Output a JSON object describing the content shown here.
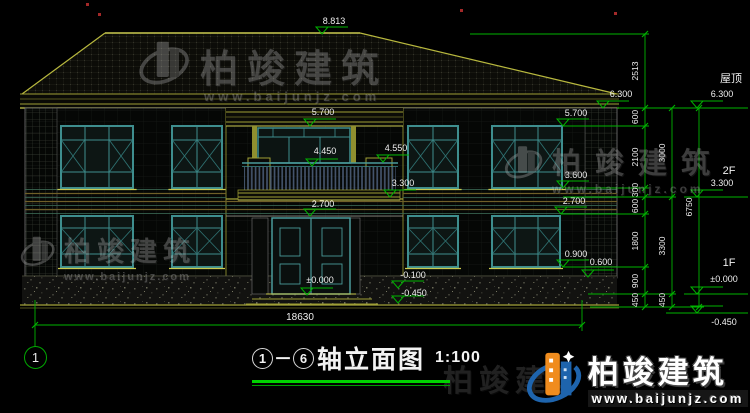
{
  "title_block": {
    "axis_start": "1",
    "separator": "－",
    "axis_end": "6",
    "name": "轴立面图",
    "scale": "1:100"
  },
  "axis_bubble": "1",
  "brand": {
    "name": "柏竣建筑",
    "url": "www.baijunjz.com"
  },
  "colors": {
    "dim_green": "#00b400",
    "text_white": "#f0f0f0",
    "roof_yellow": "#caca50",
    "olive": "#8f8f2f",
    "window_teal": "#3e8e8e",
    "logo_blue": "#1e64ad",
    "logo_orange": "#f08c1e",
    "red_mark": "#c03030"
  },
  "annotations": {
    "level_markers": [
      {
        "label": "8.813",
        "x": 322,
        "y": 34,
        "lx": 334,
        "ly": 24
      },
      {
        "label": "6.300",
        "x": 603,
        "y": 108,
        "lx": 621,
        "ly": 97
      },
      {
        "label": "5.700",
        "x": 310,
        "y": 126,
        "lx": 323,
        "ly": 115
      },
      {
        "label": "5.700",
        "x": 563,
        "y": 126,
        "lx": 576,
        "ly": 116
      },
      {
        "label": "4.450",
        "x": 312,
        "y": 166,
        "lx": 325,
        "ly": 154
      },
      {
        "label": "4.550",
        "x": 383,
        "y": 162,
        "lx": 396,
        "ly": 151
      },
      {
        "label": "3.300",
        "x": 390,
        "y": 197,
        "lx": 403,
        "ly": 186
      },
      {
        "label": "2.700",
        "x": 310,
        "y": 216,
        "lx": 323,
        "ly": 207
      },
      {
        "label": "3.600",
        "x": 563,
        "y": 188,
        "lx": 576,
        "ly": 178
      },
      {
        "label": "2.700",
        "x": 561,
        "y": 214,
        "lx": 574,
        "ly": 204
      },
      {
        "label": "0.900",
        "x": 563,
        "y": 267,
        "lx": 576,
        "ly": 257
      },
      {
        "label": "0.600",
        "x": 588,
        "y": 277,
        "lx": 601,
        "ly": 265
      },
      {
        "label": "±0.000",
        "x": 307,
        "y": 295,
        "lx": 320,
        "ly": 283
      },
      {
        "label": "-0.100",
        "x": 398,
        "y": 288,
        "lx": 413,
        "ly": 278
      },
      {
        "label": "-0.450",
        "x": 398,
        "y": 303,
        "lx": 414,
        "ly": 296
      },
      {
        "label": "6.300",
        "x": 697,
        "y": 108,
        "lx": 722,
        "ly": 97
      },
      {
        "label": "3.300",
        "x": 697,
        "y": 197,
        "lx": 722,
        "ly": 186
      },
      {
        "label": "±0.000",
        "x": 697,
        "y": 294,
        "lx": 724,
        "ly": 282
      },
      {
        "label": "-0.450",
        "x": 697,
        "y": 313,
        "lx": 724,
        "ly": 325
      }
    ],
    "dim_chains": [
      {
        "id": "chain-inner",
        "x": 638,
        "segments": [
          {
            "t": "2513",
            "y": 71
          },
          {
            "t": "600",
            "y": 117
          },
          {
            "t": "2100",
            "y": 157
          },
          {
            "t": "300",
            "y": 190
          },
          {
            "t": "600",
            "y": 206
          },
          {
            "t": "1800",
            "y": 241
          },
          {
            "t": "900",
            "y": 281
          },
          {
            "t": "450",
            "y": 300
          }
        ]
      },
      {
        "id": "chain-middle",
        "x": 665,
        "segments": [
          {
            "t": "3000",
            "y": 153
          },
          {
            "t": "3300",
            "y": 246
          },
          {
            "t": "450",
            "y": 300
          }
        ]
      },
      {
        "id": "chain-outer",
        "x": 692,
        "segments": [
          {
            "t": "6750",
            "y": 207
          }
        ]
      }
    ],
    "texts": [
      {
        "t": "屋顶",
        "x": 731,
        "y": 82,
        "fs": 11
      },
      {
        "t": "2F",
        "x": 729,
        "y": 174,
        "fs": 11
      },
      {
        "t": "1F",
        "x": 729,
        "y": 266,
        "fs": 11
      },
      {
        "t": "18630",
        "x": 300,
        "y": 320,
        "fs": 10
      }
    ]
  }
}
